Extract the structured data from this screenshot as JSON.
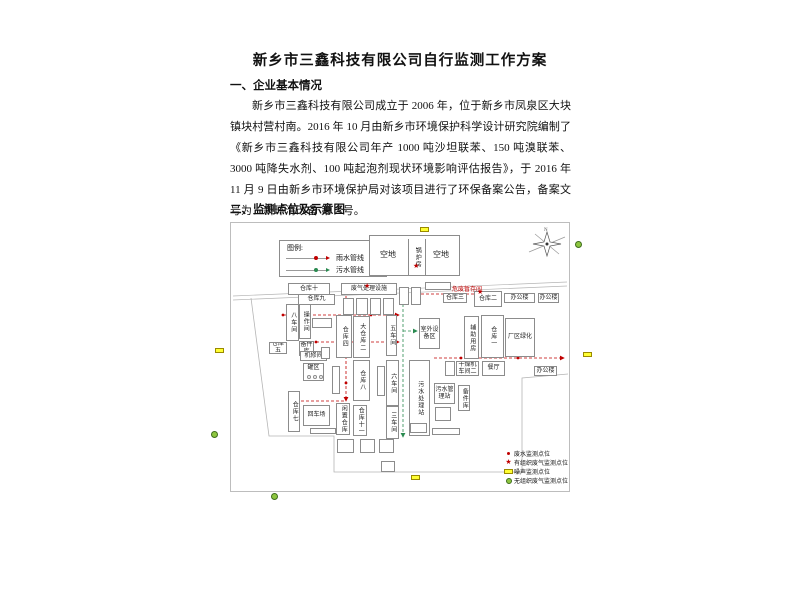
{
  "document": {
    "title": "新乡市三鑫科技有限公司自行监测工作方案",
    "section1_heading": "一、企业基本情况",
    "section1_paragraph": "新乡市三鑫科技有限公司成立于 2006 年，位于新乡市凤泉区大块镇块村营村南。2016 年 10 月由新乡市环境保护科学设计研究院编制了《新乡市三鑫科技有限公司年产 1000 吨沙坦联苯、150 吨溴联苯、3000 吨降失水剂、100 吨起泡剂现状环境影响评估报告》，于 2016 年 11 月 9 日由新乡市环境保护局对该项目进行了环保备案公告，备案文号为：新环清改备 第 2 号。",
    "section2_heading": "二、监测点位及示意图"
  },
  "diagram": {
    "legend": {
      "title": "图例:",
      "rain_line": "雨水管线",
      "sewage_line": "污水管线"
    },
    "compass_label": "N",
    "marker_legend": [
      {
        "icon": "red-dot",
        "label": "废水监测点位"
      },
      {
        "icon": "red-star",
        "label": "有组织废气监测点位"
      },
      {
        "icon": "yellow-rect",
        "label": "噪声监测点位"
      },
      {
        "icon": "green-circle",
        "label": "无组织废气监测点位"
      }
    ],
    "labels": {
      "kongdi1": "空地",
      "kongdi2": "空地",
      "guolufang": "锅炉房",
      "cangku10": "仓库十",
      "cangku9": "仓库九",
      "bachejian": "八车间",
      "caozuojian": "操作间",
      "cangku5": "仓库五",
      "beijianku": "备件库",
      "jixiujian": "机修间",
      "guanqu": "罐区",
      "cangku7": "仓库七",
      "huichechang": "回车场",
      "cangku4": "仓库四",
      "dacangku2": "大仓库二",
      "cangku8": "仓库八",
      "xianzhicangku": "闲置仓库",
      "cangku11": "仓库十一",
      "feiqichuli": "废气处理设施",
      "wuchejian": "五车间",
      "liuchejian": "六车间",
      "sanchejian": "三车间",
      "wushuichulizhan": "污水处理站",
      "shiwaishebeiqu": "室外设备区",
      "wushuiguanlizhan": "污水管理站",
      "beijianku2": "备件库",
      "cangku3": "仓库三",
      "cangku2": "仓库二",
      "bangonglou1": "办公楼",
      "bangonglou2": "办公楼",
      "bangonglou3": "办公楼",
      "fuzhuyongfang": "辅助用房",
      "cangku1": "仓库一",
      "changqulvhua": "厂区绿化",
      "ganzaojichejian2": "干燥机车间二",
      "canting": "餐厅",
      "weifeizancunjian": "危废暂存间"
    },
    "colors": {
      "rain_pipeline": "#c00000",
      "sewage_pipeline": "#2a8a50",
      "noise_marker": "#ffff33",
      "fugitive_gas_marker": "#8dc63f"
    }
  }
}
